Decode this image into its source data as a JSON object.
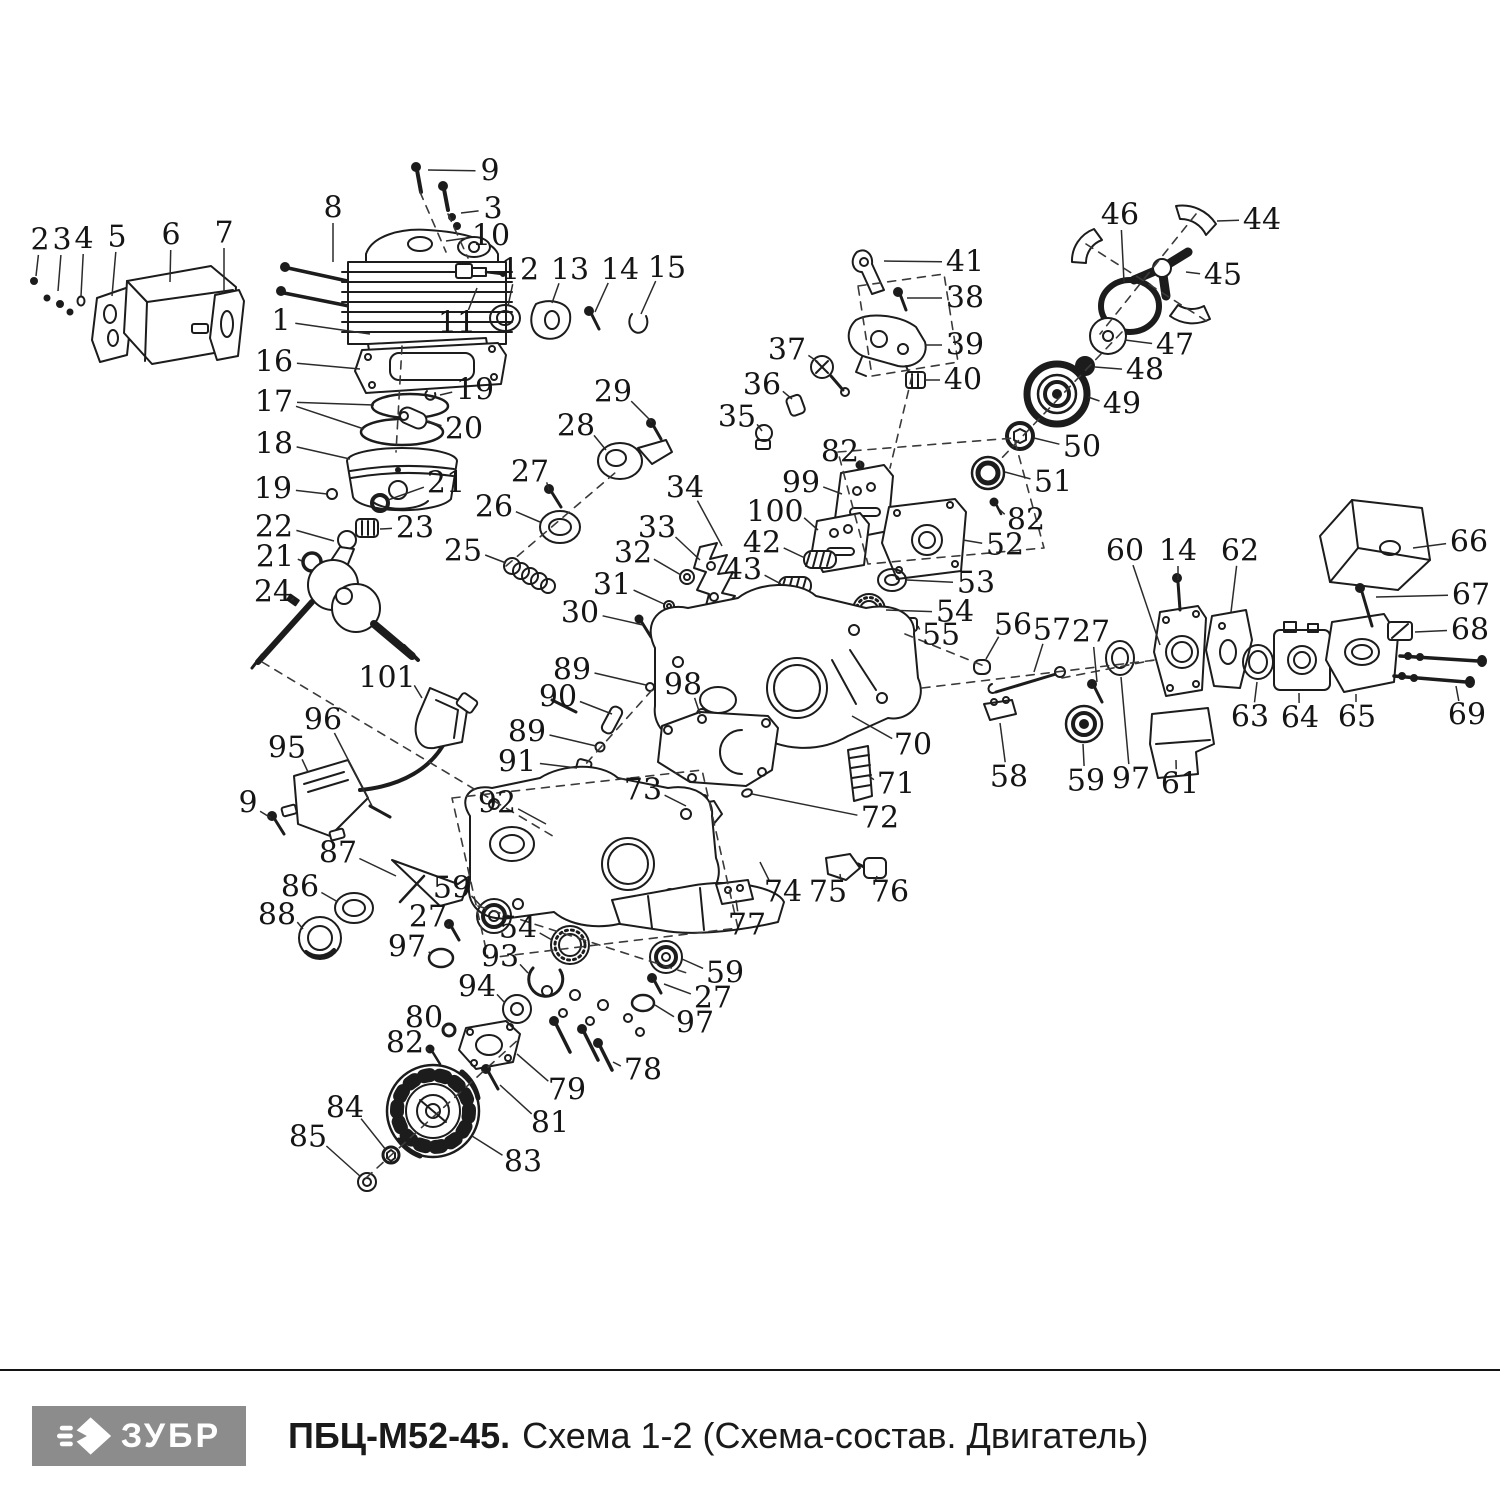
{
  "footer": {
    "logo_text": "ЗУБР",
    "title_bold": "ПБЦ-М52-45.",
    "title_rest": "Схема 1-2 (Схема-состав. Двигатель)",
    "logo_bg": "#8c8c8c",
    "divider_color": "#141414",
    "text_color": "#1a1a1a"
  },
  "diagram": {
    "description": "Exploded view of chainsaw engine with numbered part callouts",
    "stroke_color": "#1c1c1c",
    "labels": [
      {
        "t": "2",
        "x": 40,
        "y": 240,
        "lx": 36,
        "ly": 276
      },
      {
        "t": "3",
        "x": 62,
        "y": 240,
        "lx": 58,
        "ly": 291
      },
      {
        "t": "4",
        "x": 84,
        "y": 239,
        "lx": 81,
        "ly": 296
      },
      {
        "t": "5",
        "x": 117,
        "y": 237,
        "lx": 112,
        "ly": 296
      },
      {
        "t": "6",
        "x": 171,
        "y": 235,
        "lx": 170,
        "ly": 282
      },
      {
        "t": "7",
        "x": 224,
        "y": 233,
        "lx": 224,
        "ly": 292
      },
      {
        "t": "8",
        "x": 333,
        "y": 208,
        "lx": 333,
        "ly": 262
      },
      {
        "t": "9",
        "x": 490,
        "y": 171,
        "lx": 428,
        "ly": 170
      },
      {
        "t": "3",
        "x": 493,
        "y": 209,
        "lx": 461,
        "ly": 213
      },
      {
        "t": "10",
        "x": 491,
        "y": 236,
        "lx": 446,
        "ly": 241
      },
      {
        "t": "1",
        "x": 281,
        "y": 321,
        "lx": 370,
        "ly": 334
      },
      {
        "t": "11",
        "x": 457,
        "y": 323,
        "lx": 477,
        "ly": 288
      },
      {
        "t": "12",
        "x": 520,
        "y": 270,
        "lx": 508,
        "ly": 306
      },
      {
        "t": "13",
        "x": 570,
        "y": 270,
        "lx": 552,
        "ly": 303
      },
      {
        "t": "14",
        "x": 620,
        "y": 270,
        "lx": 595,
        "ly": 312
      },
      {
        "t": "15",
        "x": 667,
        "y": 268,
        "lx": 641,
        "ly": 314
      },
      {
        "t": "16",
        "x": 274,
        "y": 362,
        "lx": 360,
        "ly": 369
      },
      {
        "t": "17",
        "x": 274,
        "y": 402,
        "lx": 374,
        "ly": 405,
        "lx2": 364,
        "ly2": 429
      },
      {
        "t": "19",
        "x": 475,
        "y": 390,
        "lx": 440,
        "ly": 395
      },
      {
        "t": "20",
        "x": 464,
        "y": 429,
        "lx": 428,
        "ly": 421
      },
      {
        "t": "18",
        "x": 274,
        "y": 444,
        "lx": 350,
        "ly": 459
      },
      {
        "t": "19",
        "x": 273,
        "y": 489,
        "lx": 327,
        "ly": 494
      },
      {
        "t": "21",
        "x": 446,
        "y": 483,
        "lx": 388,
        "ly": 500
      },
      {
        "t": "22",
        "x": 274,
        "y": 527,
        "lx": 334,
        "ly": 541
      },
      {
        "t": "23",
        "x": 415,
        "y": 528,
        "lx": 380,
        "ly": 529
      },
      {
        "t": "21",
        "x": 275,
        "y": 557,
        "lx": 302,
        "ly": 561
      },
      {
        "t": "24",
        "x": 273,
        "y": 592,
        "lx": 291,
        "ly": 600
      },
      {
        "t": "29",
        "x": 613,
        "y": 392,
        "lx": 652,
        "ly": 422
      },
      {
        "t": "28",
        "x": 576,
        "y": 426,
        "lx": 606,
        "ly": 450
      },
      {
        "t": "27",
        "x": 530,
        "y": 472,
        "lx": 549,
        "ly": 490
      },
      {
        "t": "26",
        "x": 494,
        "y": 507,
        "lx": 540,
        "ly": 522
      },
      {
        "t": "25",
        "x": 463,
        "y": 551,
        "lx": 506,
        "ly": 563
      },
      {
        "t": "34",
        "x": 685,
        "y": 488,
        "lx": 722,
        "ly": 546
      },
      {
        "t": "33",
        "x": 657,
        "y": 528,
        "lx": 700,
        "ly": 560
      },
      {
        "t": "32",
        "x": 633,
        "y": 553,
        "lx": 681,
        "ly": 575
      },
      {
        "t": "31",
        "x": 612,
        "y": 585,
        "lx": 664,
        "ly": 604
      },
      {
        "t": "30",
        "x": 580,
        "y": 613,
        "lx": 643,
        "ly": 625
      },
      {
        "t": "41",
        "x": 965,
        "y": 262,
        "lx": 884,
        "ly": 261
      },
      {
        "t": "38",
        "x": 965,
        "y": 298,
        "lx": 907,
        "ly": 298
      },
      {
        "t": "39",
        "x": 965,
        "y": 345,
        "lx": 925,
        "ly": 345
      },
      {
        "t": "40",
        "x": 963,
        "y": 380,
        "lx": 925,
        "ly": 380
      },
      {
        "t": "37",
        "x": 787,
        "y": 350,
        "lx": 818,
        "ly": 362
      },
      {
        "t": "36",
        "x": 762,
        "y": 385,
        "lx": 792,
        "ly": 399
      },
      {
        "t": "35",
        "x": 737,
        "y": 417,
        "lx": 762,
        "ly": 431
      },
      {
        "t": "46",
        "x": 1120,
        "y": 215,
        "lx": 1124,
        "ly": 282
      },
      {
        "t": "44",
        "x": 1262,
        "y": 220,
        "lx": 1217,
        "ly": 221
      },
      {
        "t": "45",
        "x": 1223,
        "y": 275,
        "lx": 1186,
        "ly": 272
      },
      {
        "t": "47",
        "x": 1175,
        "y": 345,
        "lx": 1125,
        "ly": 340
      },
      {
        "t": "48",
        "x": 1145,
        "y": 370,
        "lx": 1095,
        "ly": 367
      },
      {
        "t": "49",
        "x": 1122,
        "y": 404,
        "lx": 1088,
        "ly": 397
      },
      {
        "t": "50",
        "x": 1082,
        "y": 447,
        "lx": 1034,
        "ly": 438
      },
      {
        "t": "51",
        "x": 1053,
        "y": 482,
        "lx": 1005,
        "ly": 472
      },
      {
        "t": "82",
        "x": 840,
        "y": 452,
        "lx": 861,
        "ly": 466
      },
      {
        "t": "99",
        "x": 801,
        "y": 483,
        "lx": 842,
        "ly": 494
      },
      {
        "t": "100",
        "x": 775,
        "y": 512,
        "lx": 818,
        "ly": 530
      },
      {
        "t": "42",
        "x": 762,
        "y": 543,
        "lx": 805,
        "ly": 558
      },
      {
        "t": "43",
        "x": 743,
        "y": 570,
        "lx": 781,
        "ly": 584
      },
      {
        "t": "82",
        "x": 1026,
        "y": 520,
        "lx": 999,
        "ly": 509
      },
      {
        "t": "52",
        "x": 1005,
        "y": 545,
        "lx": 963,
        "ly": 540
      },
      {
        "t": "53",
        "x": 976,
        "y": 583,
        "lx": 907,
        "ly": 580
      },
      {
        "t": "54",
        "x": 955,
        "y": 612,
        "lx": 886,
        "ly": 610
      },
      {
        "t": "55",
        "x": 941,
        "y": 635,
        "lx": 918,
        "ly": 626
      },
      {
        "t": "56",
        "x": 1013,
        "y": 625,
        "lx": 986,
        "ly": 659
      },
      {
        "t": "57",
        "x": 1052,
        "y": 630,
        "lx": 1034,
        "ly": 672
      },
      {
        "t": "27",
        "x": 1091,
        "y": 632,
        "lx": 1097,
        "ly": 682
      },
      {
        "t": "60",
        "x": 1125,
        "y": 551,
        "lx": 1160,
        "ly": 645
      },
      {
        "t": "14",
        "x": 1178,
        "y": 551,
        "lx": 1178,
        "ly": 580
      },
      {
        "t": "62",
        "x": 1240,
        "y": 551,
        "lx": 1231,
        "ly": 612
      },
      {
        "t": "66",
        "x": 1469,
        "y": 542,
        "lx": 1413,
        "ly": 548
      },
      {
        "t": "67",
        "x": 1471,
        "y": 595,
        "lx": 1376,
        "ly": 597
      },
      {
        "t": "68",
        "x": 1470,
        "y": 630,
        "lx": 1415,
        "ly": 632
      },
      {
        "t": "69",
        "x": 1467,
        "y": 715,
        "lx": 1456,
        "ly": 686
      },
      {
        "t": "63",
        "x": 1250,
        "y": 717,
        "lx": 1257,
        "ly": 682
      },
      {
        "t": "64",
        "x": 1300,
        "y": 718,
        "lx": 1299,
        "ly": 693
      },
      {
        "t": "65",
        "x": 1357,
        "y": 717,
        "lx": 1356,
        "ly": 694
      },
      {
        "t": "58",
        "x": 1009,
        "y": 777,
        "lx": 1000,
        "ly": 723
      },
      {
        "t": "59",
        "x": 1086,
        "y": 781,
        "lx": 1083,
        "ly": 744
      },
      {
        "t": "97",
        "x": 1131,
        "y": 779,
        "lx": 1121,
        "ly": 677
      },
      {
        "t": "61",
        "x": 1180,
        "y": 784,
        "lx": 1176,
        "ly": 760
      },
      {
        "t": "89",
        "x": 572,
        "y": 670,
        "lx": 646,
        "ly": 685
      },
      {
        "t": "90",
        "x": 558,
        "y": 697,
        "lx": 612,
        "ly": 714
      },
      {
        "t": "98",
        "x": 683,
        "y": 685,
        "lx": 700,
        "ly": 714
      },
      {
        "t": "89",
        "x": 527,
        "y": 732,
        "lx": 596,
        "ly": 746
      },
      {
        "t": "91",
        "x": 517,
        "y": 762,
        "lx": 577,
        "ly": 768
      },
      {
        "t": "70",
        "x": 913,
        "y": 745,
        "lx": 852,
        "ly": 716
      },
      {
        "t": "71",
        "x": 896,
        "y": 784,
        "lx": 869,
        "ly": 776
      },
      {
        "t": "72",
        "x": 880,
        "y": 818,
        "lx": 752,
        "ly": 794
      },
      {
        "t": "73",
        "x": 643,
        "y": 790,
        "lx": 686,
        "ly": 806
      },
      {
        "t": "92",
        "x": 497,
        "y": 803,
        "lx": 546,
        "ly": 824
      },
      {
        "t": "74",
        "x": 783,
        "y": 892,
        "lx": 760,
        "ly": 862
      },
      {
        "t": "75",
        "x": 828,
        "y": 892,
        "lx": 840,
        "ly": 874
      },
      {
        "t": "76",
        "x": 890,
        "y": 892,
        "lx": 877,
        "ly": 876
      },
      {
        "t": "77",
        "x": 747,
        "y": 925,
        "lx": 736,
        "ly": 900
      },
      {
        "t": "101",
        "x": 387,
        "y": 678,
        "lx": 422,
        "ly": 698
      },
      {
        "t": "96",
        "x": 323,
        "y": 720,
        "lx": 372,
        "ly": 806
      },
      {
        "t": "95",
        "x": 287,
        "y": 748,
        "lx": 308,
        "ly": 772
      },
      {
        "t": "9",
        "x": 248,
        "y": 803,
        "lx": 271,
        "ly": 818
      },
      {
        "t": "87",
        "x": 338,
        "y": 853,
        "lx": 396,
        "ly": 876
      },
      {
        "t": "86",
        "x": 300,
        "y": 887,
        "lx": 338,
        "ly": 902
      },
      {
        "t": "88",
        "x": 277,
        "y": 915,
        "lx": 303,
        "ly": 929
      },
      {
        "t": "59",
        "x": 452,
        "y": 888,
        "lx": 481,
        "ly": 906
      },
      {
        "t": "27",
        "x": 428,
        "y": 917,
        "lx": 447,
        "ly": 926
      },
      {
        "t": "97",
        "x": 407,
        "y": 947,
        "lx": 431,
        "ly": 955
      },
      {
        "t": "54",
        "x": 518,
        "y": 928,
        "lx": 552,
        "ly": 940
      },
      {
        "t": "93",
        "x": 500,
        "y": 957,
        "lx": 528,
        "ly": 973
      },
      {
        "t": "94",
        "x": 477,
        "y": 987,
        "lx": 505,
        "ly": 1003
      },
      {
        "t": "80",
        "x": 424,
        "y": 1018,
        "lx": 444,
        "ly": 1028
      },
      {
        "t": "82",
        "x": 405,
        "y": 1043,
        "lx": 429,
        "ly": 1051
      },
      {
        "t": "59",
        "x": 725,
        "y": 973,
        "lx": 682,
        "ly": 959
      },
      {
        "t": "27",
        "x": 713,
        "y": 998,
        "lx": 664,
        "ly": 984
      },
      {
        "t": "97",
        "x": 695,
        "y": 1023,
        "lx": 655,
        "ly": 1005
      },
      {
        "t": "78",
        "x": 643,
        "y": 1070,
        "lx": 613,
        "ly": 1062
      },
      {
        "t": "79",
        "x": 567,
        "y": 1090,
        "lx": 517,
        "ly": 1054
      },
      {
        "t": "81",
        "x": 550,
        "y": 1123,
        "lx": 500,
        "ly": 1085
      },
      {
        "t": "84",
        "x": 345,
        "y": 1108,
        "lx": 386,
        "ly": 1150
      },
      {
        "t": "85",
        "x": 308,
        "y": 1137,
        "lx": 361,
        "ly": 1177
      },
      {
        "t": "83",
        "x": 523,
        "y": 1162,
        "lx": 472,
        "ly": 1136
      }
    ]
  }
}
